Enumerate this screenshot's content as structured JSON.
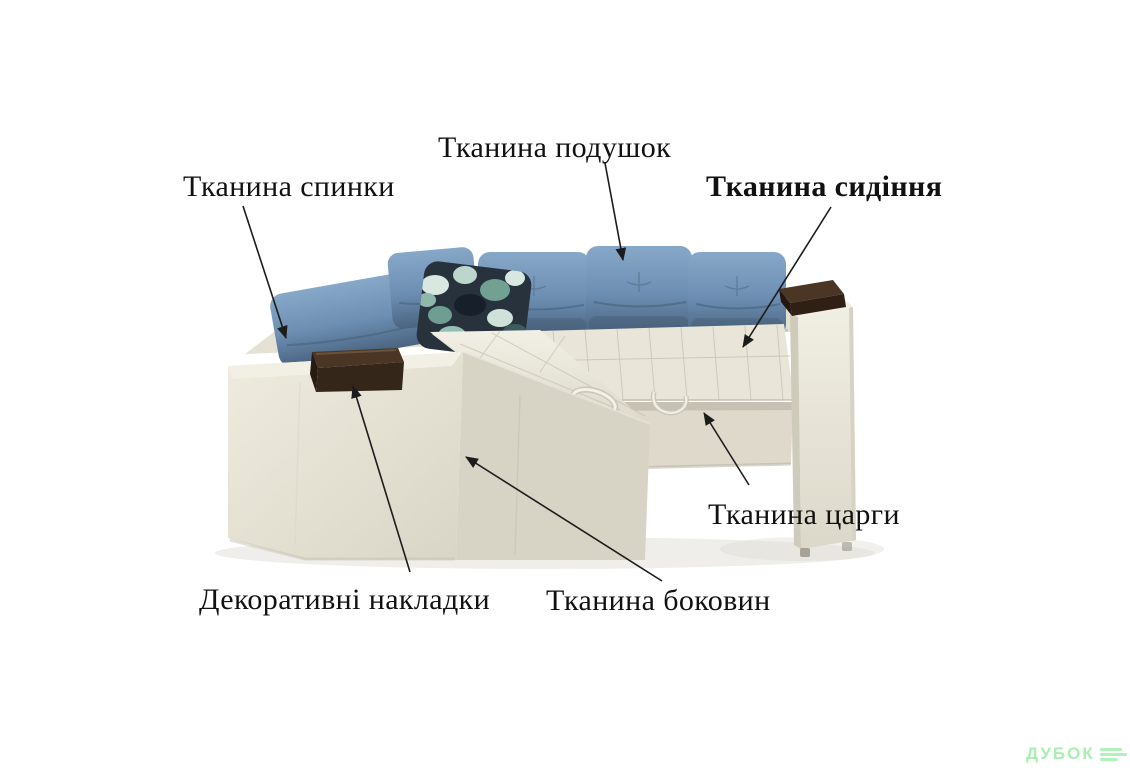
{
  "page": {
    "background_color": "#ffffff"
  },
  "annotations": {
    "labels": [
      {
        "id": "cushion-fabric",
        "text": "Тканина подушок"
      },
      {
        "id": "back-fabric",
        "text": "Тканина спинки"
      },
      {
        "id": "seat-fabric",
        "text": "Тканина сидіння"
      },
      {
        "id": "frame-fabric",
        "text": "Тканина царги"
      },
      {
        "id": "decorative-overlays",
        "text": "Декоративні накладки"
      },
      {
        "id": "side-fabric",
        "text": "Тканина боковин"
      }
    ]
  },
  "watermark": {
    "text": "ДУБОК",
    "color": "#a9efb2"
  },
  "colors": {
    "label_text": "#111111",
    "arrow": "#1c1c1c",
    "sofa_body": "#e9e6d9",
    "sofa_body_shade": "#d8d4c5",
    "tsarga_panel": "#ded9ca",
    "cushion_blue": "#6d8fb3",
    "cushion_blue_dark": "#4e6a80",
    "wood_pad": "#4b3626",
    "pattern_pillow_base": "#28323c"
  }
}
